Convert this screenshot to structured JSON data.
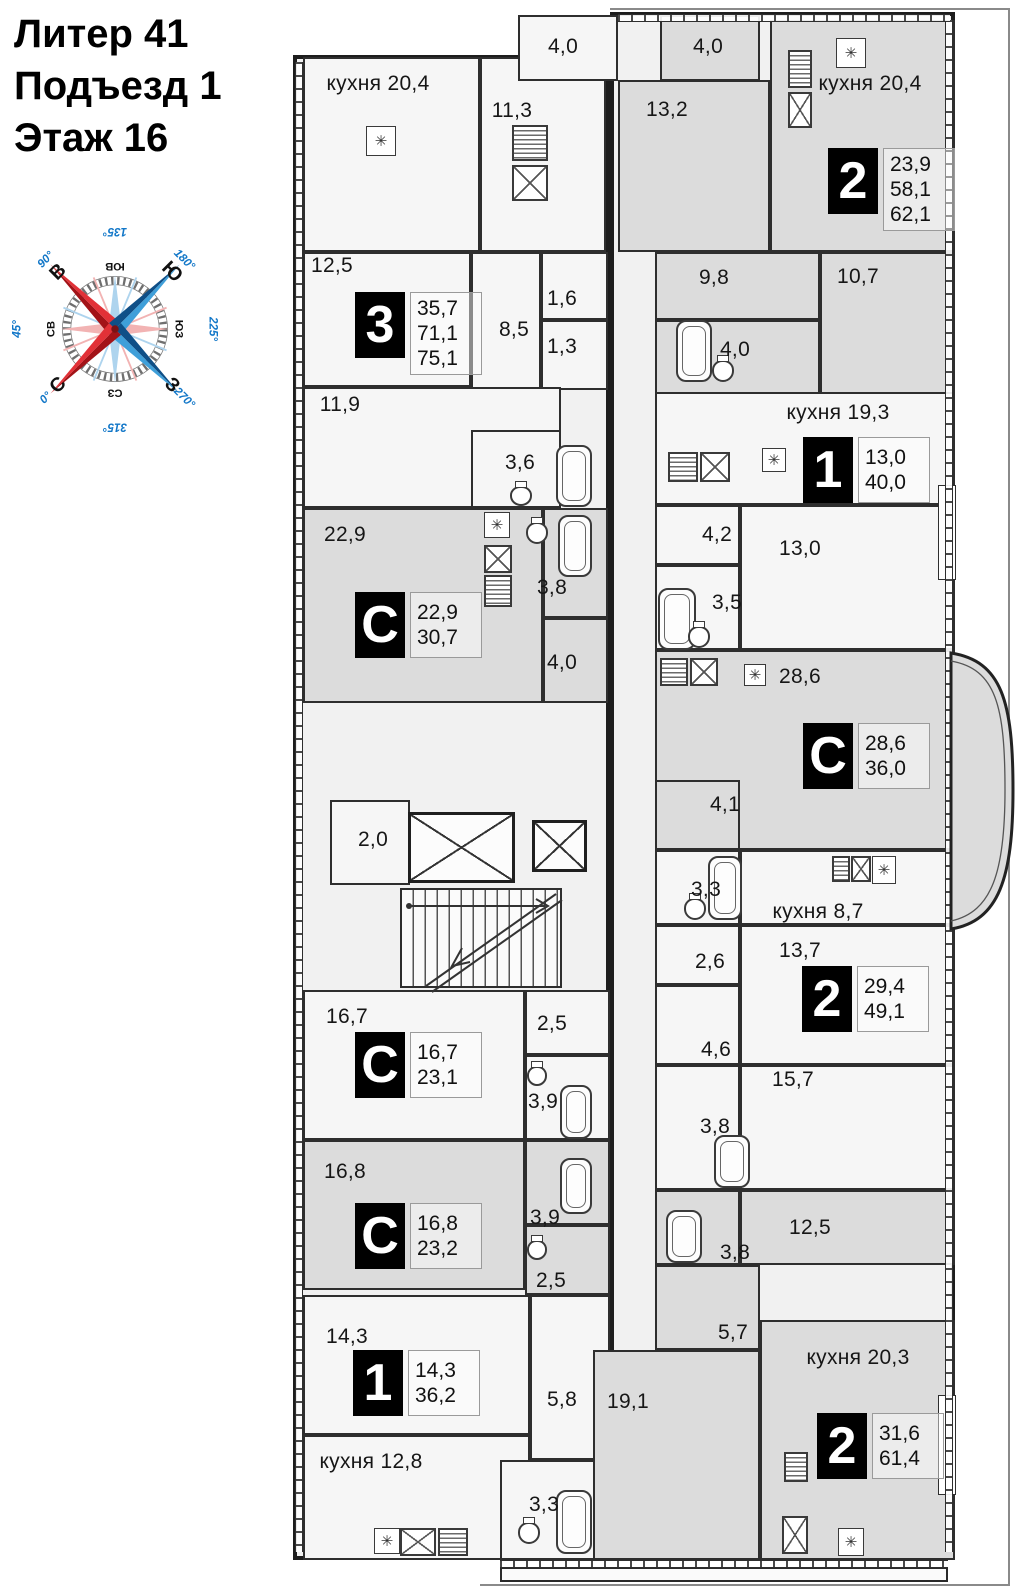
{
  "header": {
    "line1": "Литер 41",
    "line2": "Подъезд 1",
    "line3": "Этаж 16"
  },
  "compass": {
    "points": [
      {
        "label": "С",
        "deg": "0°",
        "screen": 225,
        "cardinal": true,
        "rot": -45
      },
      {
        "label": "СВ",
        "deg": "45°",
        "screen": 270,
        "cardinal": false,
        "rot": -90
      },
      {
        "label": "В",
        "deg": "90°",
        "screen": 315,
        "cardinal": true,
        "rot": -45
      },
      {
        "label": "ЮВ",
        "deg": "135°",
        "screen": 0,
        "cardinal": false,
        "rot": 180
      },
      {
        "label": "Ю",
        "deg": "180°",
        "screen": 45,
        "cardinal": true,
        "rot": 45
      },
      {
        "label": "ЮЗ",
        "deg": "225°",
        "screen": 90,
        "cardinal": false,
        "rot": 90
      },
      {
        "label": "З",
        "deg": "270°",
        "screen": 135,
        "cardinal": true,
        "rot": 45
      },
      {
        "label": "СЗ",
        "deg": "315°",
        "screen": 180,
        "cardinal": false,
        "rot": 180
      }
    ],
    "colors": {
      "red_light": "#e23137",
      "red_dark": "#a31318",
      "blue_light": "#3f9fd9",
      "blue_dark": "#0f4f87",
      "degree_text": "#1277c8",
      "pale_red": "#f2b3b3",
      "pale_blue": "#aed4ee"
    }
  },
  "plan": {
    "colors": {
      "wall": "#1d1d1d",
      "room_light": "#f6f6f6",
      "room_gray": "#dcdcdc",
      "badge_bg": "#000000",
      "badge_fg": "#ffffff"
    },
    "icons": {
      "vent": "✳"
    },
    "rooms": [
      {
        "x": 303,
        "y": 57,
        "w": 177,
        "h": 195,
        "f": "light"
      },
      {
        "x": 480,
        "y": 57,
        "w": 126,
        "h": 195,
        "f": "light"
      },
      {
        "x": 518,
        "y": 15,
        "w": 100,
        "h": 66,
        "f": "light"
      },
      {
        "x": 660,
        "y": 15,
        "w": 100,
        "h": 66,
        "f": "gray"
      },
      {
        "x": 618,
        "y": 80,
        "w": 152,
        "h": 172,
        "f": "gray"
      },
      {
        "x": 770,
        "y": 20,
        "w": 185,
        "h": 232,
        "f": "gray"
      },
      {
        "x": 303,
        "y": 252,
        "w": 168,
        "h": 135,
        "f": "light"
      },
      {
        "x": 471,
        "y": 252,
        "w": 70,
        "h": 178,
        "f": "light"
      },
      {
        "x": 541,
        "y": 252,
        "w": 67,
        "h": 68,
        "f": "light"
      },
      {
        "x": 541,
        "y": 320,
        "w": 67,
        "h": 70,
        "f": "light"
      },
      {
        "x": 303,
        "y": 387,
        "w": 258,
        "h": 121,
        "f": "light"
      },
      {
        "x": 471,
        "y": 430,
        "w": 90,
        "h": 78,
        "f": "light"
      },
      {
        "x": 655,
        "y": 252,
        "w": 165,
        "h": 68,
        "f": "gray"
      },
      {
        "x": 820,
        "y": 252,
        "w": 135,
        "h": 178,
        "f": "gray"
      },
      {
        "x": 655,
        "y": 320,
        "w": 165,
        "h": 110,
        "f": "gray"
      },
      {
        "x": 303,
        "y": 508,
        "w": 240,
        "h": 195,
        "f": "gray"
      },
      {
        "x": 543,
        "y": 508,
        "w": 65,
        "h": 110,
        "f": "gray"
      },
      {
        "x": 543,
        "y": 618,
        "w": 65,
        "h": 85,
        "f": "gray"
      },
      {
        "x": 655,
        "y": 392,
        "w": 300,
        "h": 113,
        "f": "light"
      },
      {
        "x": 655,
        "y": 505,
        "w": 85,
        "h": 60,
        "f": "light"
      },
      {
        "x": 740,
        "y": 505,
        "w": 215,
        "h": 145,
        "f": "light"
      },
      {
        "x": 655,
        "y": 565,
        "w": 85,
        "h": 85,
        "f": "light"
      },
      {
        "x": 655,
        "y": 650,
        "w": 300,
        "h": 200,
        "f": "gray"
      },
      {
        "x": 655,
        "y": 780,
        "w": 85,
        "h": 70,
        "f": "gray"
      },
      {
        "x": 655,
        "y": 850,
        "w": 85,
        "h": 75,
        "f": "light"
      },
      {
        "x": 740,
        "y": 850,
        "w": 215,
        "h": 75,
        "f": "light"
      },
      {
        "x": 655,
        "y": 925,
        "w": 85,
        "h": 60,
        "f": "light"
      },
      {
        "x": 740,
        "y": 925,
        "w": 215,
        "h": 140,
        "f": "light"
      },
      {
        "x": 655,
        "y": 985,
        "w": 85,
        "h": 80,
        "f": "light"
      },
      {
        "x": 740,
        "y": 1065,
        "w": 215,
        "h": 125,
        "f": "light"
      },
      {
        "x": 655,
        "y": 1065,
        "w": 85,
        "h": 125,
        "f": "light"
      },
      {
        "x": 303,
        "y": 990,
        "w": 222,
        "h": 150,
        "f": "light"
      },
      {
        "x": 525,
        "y": 990,
        "w": 85,
        "h": 65,
        "f": "light"
      },
      {
        "x": 525,
        "y": 1055,
        "w": 85,
        "h": 85,
        "f": "light"
      },
      {
        "x": 303,
        "y": 1140,
        "w": 222,
        "h": 150,
        "f": "gray"
      },
      {
        "x": 525,
        "y": 1140,
        "w": 85,
        "h": 85,
        "f": "gray"
      },
      {
        "x": 525,
        "y": 1225,
        "w": 85,
        "h": 70,
        "f": "gray"
      },
      {
        "x": 740,
        "y": 1190,
        "w": 215,
        "h": 75,
        "f": "gray"
      },
      {
        "x": 655,
        "y": 1190,
        "w": 85,
        "h": 75,
        "f": "gray"
      },
      {
        "x": 655,
        "y": 1265,
        "w": 105,
        "h": 85,
        "f": "gray"
      },
      {
        "x": 303,
        "y": 1295,
        "w": 227,
        "h": 140,
        "f": "light"
      },
      {
        "x": 530,
        "y": 1295,
        "w": 80,
        "h": 165,
        "f": "light"
      },
      {
        "x": 303,
        "y": 1435,
        "w": 227,
        "h": 125,
        "f": "light"
      },
      {
        "x": 500,
        "y": 1460,
        "w": 110,
        "h": 100,
        "f": "light"
      },
      {
        "x": 760,
        "y": 1320,
        "w": 195,
        "h": 240,
        "f": "gray"
      },
      {
        "x": 593,
        "y": 1350,
        "w": 167,
        "h": 210,
        "f": "gray"
      },
      {
        "x": 330,
        "y": 800,
        "w": 80,
        "h": 85,
        "f": "light"
      }
    ],
    "labels": [
      {
        "t": "кухня 20,4",
        "x": 378,
        "y": 84
      },
      {
        "t": "4,0",
        "x": 563,
        "y": 47
      },
      {
        "t": "4,0",
        "x": 708,
        "y": 47
      },
      {
        "t": "11,3",
        "x": 512,
        "y": 111
      },
      {
        "t": "13,2",
        "x": 667,
        "y": 110
      },
      {
        "t": "кухня 20,4",
        "x": 870,
        "y": 84
      },
      {
        "t": "12,5",
        "x": 332,
        "y": 266
      },
      {
        "t": "8,5",
        "x": 514,
        "y": 330
      },
      {
        "t": "1,6",
        "x": 562,
        "y": 299
      },
      {
        "t": "1,3",
        "x": 562,
        "y": 347
      },
      {
        "t": "9,8",
        "x": 714,
        "y": 278
      },
      {
        "t": "10,7",
        "x": 858,
        "y": 277
      },
      {
        "t": "4,0",
        "x": 735,
        "y": 350
      },
      {
        "t": "11,9",
        "x": 340,
        "y": 405
      },
      {
        "t": "3,6",
        "x": 520,
        "y": 463
      },
      {
        "t": "кухня 19,3",
        "x": 838,
        "y": 413
      },
      {
        "t": "4,2",
        "x": 717,
        "y": 535
      },
      {
        "t": "13,0",
        "x": 800,
        "y": 549
      },
      {
        "t": "22,9",
        "x": 345,
        "y": 535
      },
      {
        "t": "3,8",
        "x": 552,
        "y": 588
      },
      {
        "t": "3,5",
        "x": 727,
        "y": 603
      },
      {
        "t": "4,0",
        "x": 562,
        "y": 663
      },
      {
        "t": "28,6",
        "x": 800,
        "y": 677
      },
      {
        "t": "4,1",
        "x": 725,
        "y": 805
      },
      {
        "t": "2,0",
        "x": 373,
        "y": 840
      },
      {
        "t": "3,3",
        "x": 706,
        "y": 890
      },
      {
        "t": "кухня 8,7",
        "x": 818,
        "y": 912
      },
      {
        "t": "2,6",
        "x": 710,
        "y": 962
      },
      {
        "t": "13,7",
        "x": 800,
        "y": 951
      },
      {
        "t": "16,7",
        "x": 347,
        "y": 1017
      },
      {
        "t": "2,5",
        "x": 552,
        "y": 1024
      },
      {
        "t": "3,9",
        "x": 543,
        "y": 1102
      },
      {
        "t": "4,6",
        "x": 716,
        "y": 1050
      },
      {
        "t": "15,7",
        "x": 793,
        "y": 1080
      },
      {
        "t": "3,8",
        "x": 715,
        "y": 1127
      },
      {
        "t": "16,8",
        "x": 345,
        "y": 1172
      },
      {
        "t": "3,9",
        "x": 545,
        "y": 1218
      },
      {
        "t": "2,5",
        "x": 551,
        "y": 1281
      },
      {
        "t": "12,5",
        "x": 810,
        "y": 1228
      },
      {
        "t": "3,8",
        "x": 735,
        "y": 1253
      },
      {
        "t": "5,7",
        "x": 733,
        "y": 1333
      },
      {
        "t": "кухня 20,3",
        "x": 858,
        "y": 1358
      },
      {
        "t": "14,3",
        "x": 347,
        "y": 1337
      },
      {
        "t": "5,8",
        "x": 562,
        "y": 1400
      },
      {
        "t": "19,1",
        "x": 628,
        "y": 1402
      },
      {
        "t": "кухня 12,8",
        "x": 371,
        "y": 1462
      },
      {
        "t": "3,3",
        "x": 544,
        "y": 1505
      }
    ],
    "badges": [
      {
        "t": "3",
        "vals": [
          "35,7",
          "71,1",
          "75,1"
        ],
        "x": 355,
        "y": 292
      },
      {
        "t": "2",
        "vals": [
          "23,9",
          "58,1",
          "62,1"
        ],
        "x": 828,
        "y": 148
      },
      {
        "t": "1",
        "vals": [
          "13,0",
          "40,0"
        ],
        "x": 803,
        "y": 437
      },
      {
        "t": "С",
        "vals": [
          "22,9",
          "30,7"
        ],
        "x": 355,
        "y": 592
      },
      {
        "t": "С",
        "vals": [
          "28,6",
          "36,0"
        ],
        "x": 803,
        "y": 723
      },
      {
        "t": "2",
        "vals": [
          "29,4",
          "49,1"
        ],
        "x": 802,
        "y": 966
      },
      {
        "t": "С",
        "vals": [
          "16,7",
          "23,1"
        ],
        "x": 355,
        "y": 1032
      },
      {
        "t": "С",
        "vals": [
          "16,8",
          "23,2"
        ],
        "x": 355,
        "y": 1203
      },
      {
        "t": "1",
        "vals": [
          "14,3",
          "36,2"
        ],
        "x": 353,
        "y": 1350
      },
      {
        "t": "2",
        "vals": [
          "31,6",
          "61,4"
        ],
        "x": 817,
        "y": 1413
      }
    ],
    "fixtures": [
      {
        "k": "lift",
        "x": 408,
        "y": 812,
        "w": 107,
        "h": 71
      },
      {
        "k": "lift",
        "x": 532,
        "y": 820,
        "w": 55,
        "h": 52
      },
      {
        "k": "bath",
        "x": 556,
        "y": 445,
        "w": 36,
        "h": 62
      },
      {
        "k": "bath",
        "x": 676,
        "y": 320,
        "w": 36,
        "h": 62
      },
      {
        "k": "bath",
        "x": 658,
        "y": 588,
        "w": 38,
        "h": 62
      },
      {
        "k": "bath",
        "x": 558,
        "y": 515,
        "w": 34,
        "h": 62
      },
      {
        "k": "bath",
        "x": 708,
        "y": 856,
        "w": 34,
        "h": 64
      },
      {
        "k": "bath",
        "x": 560,
        "y": 1085,
        "w": 32,
        "h": 54
      },
      {
        "k": "bath",
        "x": 560,
        "y": 1158,
        "w": 32,
        "h": 56
      },
      {
        "k": "bath",
        "x": 714,
        "y": 1135,
        "w": 36,
        "h": 53
      },
      {
        "k": "bath",
        "x": 666,
        "y": 1210,
        "w": 36,
        "h": 53
      },
      {
        "k": "bath",
        "x": 556,
        "y": 1490,
        "w": 36,
        "h": 64
      },
      {
        "k": "sink",
        "x": 512,
        "y": 165,
        "w": 36,
        "h": 36
      },
      {
        "k": "sink",
        "x": 788,
        "y": 92,
        "w": 24,
        "h": 36
      },
      {
        "k": "sink",
        "x": 700,
        "y": 452,
        "w": 30,
        "h": 30
      },
      {
        "k": "sink",
        "x": 484,
        "y": 545,
        "w": 28,
        "h": 28
      },
      {
        "k": "sink",
        "x": 851,
        "y": 856,
        "w": 20,
        "h": 26
      },
      {
        "k": "sink",
        "x": 400,
        "y": 1528,
        "w": 36,
        "h": 28
      },
      {
        "k": "sink",
        "x": 782,
        "y": 1516,
        "w": 26,
        "h": 38
      },
      {
        "k": "sink",
        "x": 690,
        "y": 658,
        "w": 28,
        "h": 28
      },
      {
        "k": "stove",
        "x": 512,
        "y": 125,
        "w": 36,
        "h": 36
      },
      {
        "k": "stove",
        "x": 788,
        "y": 50,
        "w": 24,
        "h": 38
      },
      {
        "k": "stove",
        "x": 668,
        "y": 452,
        "w": 30,
        "h": 30
      },
      {
        "k": "stove",
        "x": 484,
        "y": 575,
        "w": 28,
        "h": 32
      },
      {
        "k": "stove",
        "x": 832,
        "y": 856,
        "w": 18,
        "h": 26
      },
      {
        "k": "stove",
        "x": 438,
        "y": 1528,
        "w": 30,
        "h": 28
      },
      {
        "k": "stove",
        "x": 784,
        "y": 1452,
        "w": 24,
        "h": 30
      },
      {
        "k": "stove",
        "x": 660,
        "y": 658,
        "w": 28,
        "h": 28
      },
      {
        "k": "ast",
        "x": 366,
        "y": 126,
        "w": 30,
        "h": 30
      },
      {
        "k": "ast",
        "x": 836,
        "y": 38,
        "w": 30,
        "h": 30
      },
      {
        "k": "ast",
        "x": 762,
        "y": 448,
        "w": 24,
        "h": 24
      },
      {
        "k": "ast",
        "x": 484,
        "y": 512,
        "w": 26,
        "h": 26
      },
      {
        "k": "ast",
        "x": 872,
        "y": 856,
        "w": 24,
        "h": 28
      },
      {
        "k": "ast",
        "x": 374,
        "y": 1528,
        "w": 26,
        "h": 26
      },
      {
        "k": "ast",
        "x": 838,
        "y": 1528,
        "w": 26,
        "h": 28
      },
      {
        "k": "ast",
        "x": 744,
        "y": 664,
        "w": 22,
        "h": 22
      },
      {
        "k": "wc",
        "x": 510,
        "y": 486,
        "w": 22,
        "h": 20
      },
      {
        "k": "wc",
        "x": 712,
        "y": 360,
        "w": 22,
        "h": 22
      },
      {
        "k": "wc",
        "x": 688,
        "y": 626,
        "w": 22,
        "h": 22
      },
      {
        "k": "wc",
        "x": 526,
        "y": 522,
        "w": 22,
        "h": 22
      },
      {
        "k": "wc",
        "x": 684,
        "y": 898,
        "w": 22,
        "h": 22
      },
      {
        "k": "wc",
        "x": 527,
        "y": 1066,
        "w": 20,
        "h": 20
      },
      {
        "k": "wc",
        "x": 527,
        "y": 1240,
        "w": 20,
        "h": 20
      },
      {
        "k": "wc",
        "x": 518,
        "y": 1522,
        "w": 22,
        "h": 22
      },
      {
        "k": "sill",
        "x": 938,
        "y": 1395,
        "w": 18,
        "h": 100
      },
      {
        "k": "sill",
        "x": 938,
        "y": 485,
        "w": 18,
        "h": 95
      }
    ]
  }
}
